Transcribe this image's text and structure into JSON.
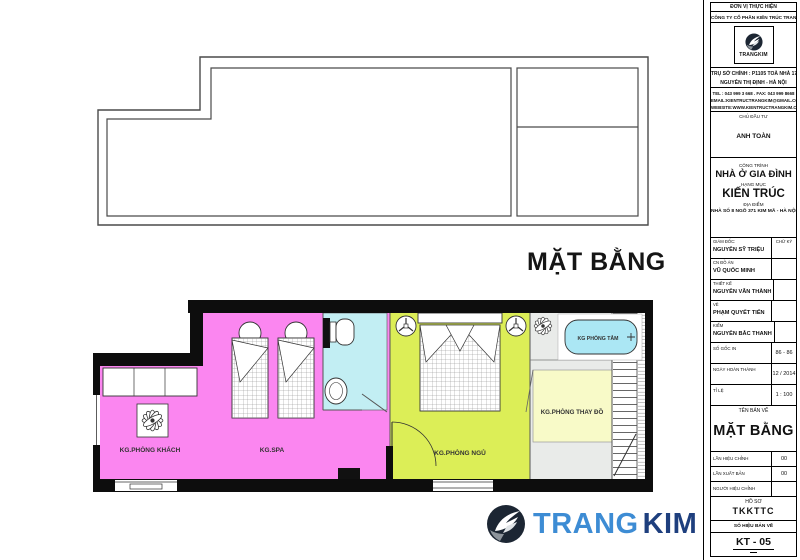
{
  "page_title": "MẶT BẰNG",
  "plan": {
    "living": "KG.PHÒNG KHÁCH",
    "spa": "KG.SPA",
    "bath": "KG PHÒNG TẮM",
    "bedroom": "KG.PHÒNG NGỦ",
    "dressing": "KG.PHÒNG THAY ĐỒ"
  },
  "colors": {
    "pink": "#fb86f0",
    "green": "#dcee57",
    "cyan": "#c2eef3",
    "tub_cyan": "#abe7f4",
    "pale_yellow": "#f8fac8",
    "light_gray": "#e9ebe9",
    "brand_light_blue": "#3d8cd4",
    "brand_dark_blue": "#1e3f7e"
  },
  "titleblock": {
    "unit_label": "ĐƠN VỊ THỰC HIỆN",
    "company": "CÔNG TY CỔ PHẦN KIẾN TRÚC TRANG KIM",
    "logo_text": "TRANGKIM",
    "addr1": "TRỤ SỞ CHÍNH : P1105 TOÀ NHÀ 17T",
    "addr2": "NGUYỄN THỊ ĐỊNH - HÀ NỘI",
    "tel": "TEL : 043 999 3 668 . FAX: 043 999 8668",
    "email": "EMAIL:KIENTRUCTRANGKIM@GMAIL.COM",
    "website": "WEBSITE:WWW.KIENTRUCTRANGKIM.COM",
    "investor_label": "CHỦ ĐẦU TƯ",
    "investor_name": "ANH TOÀN",
    "project_label": "CÔNG TRÌNH",
    "project_name": "NHÀ Ở GIA ĐÌNH",
    "item_label": "HẠNG MỤC",
    "item_name": "KIẾN TRÚC",
    "site_label": "ĐỊA ĐIỂM",
    "site_name": "NHÀ SỐ 8 NGÕ 371 KIM MÃ - HÀ NỘI",
    "sign_label": "CHỮ KÝ",
    "signers": [
      {
        "label": "GIÁM ĐỐC:",
        "name": "NGUYỄN SỸ TRIỆU"
      },
      {
        "label": "CN ĐỒ ÁN",
        "name": "VŨ QUỐC MINH"
      },
      {
        "label": "THIẾT KẾ",
        "name": "NGUYỄN VĂN THÀNH"
      },
      {
        "label": "VẼ",
        "name": "PHẠM QUYẾT TIẾN"
      },
      {
        "label": "KIỂM",
        "name": "NGUYỄN BẮC THANH"
      }
    ],
    "meta": [
      {
        "label": "SỐ GỐC IN",
        "value": "86 - 86"
      },
      {
        "label": "NGÀY HOÀN THÀNH",
        "value": "12 / 2014"
      },
      {
        "label": "TỈ LỆ",
        "value": "1 : 100"
      }
    ],
    "name_label": "TÊN BẢN VẼ",
    "drawing_name": "MẶT BẰNG",
    "revisions": [
      {
        "label": "LẦN HIỆU CHỈNH",
        "value": "00"
      },
      {
        "label": "LẦN XUẤT BẢN",
        "value": "00"
      },
      {
        "label": "NGƯỜI HIỆU CHỈNH",
        "value": ""
      }
    ],
    "dossier_label": "HỒ SƠ",
    "dossier_value": "TKKTTC",
    "sheet_label": "SỐ HIỆU BẢN VẼ",
    "sheet_value": "KT - 05"
  },
  "footer_logo": {
    "part1": "TRANG",
    "part2": "KIM"
  }
}
